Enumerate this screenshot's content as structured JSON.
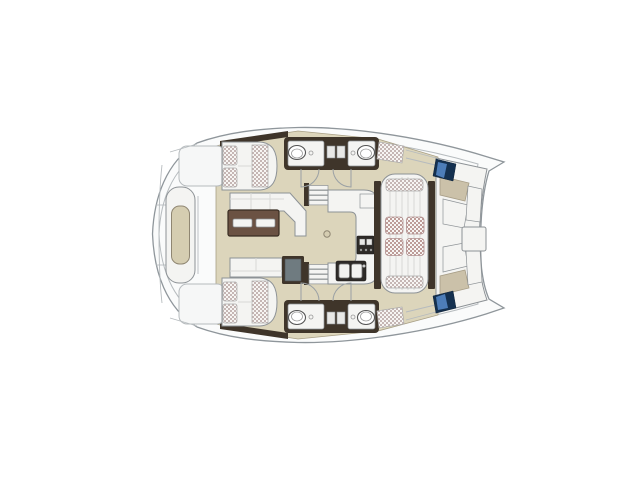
{
  "page": {
    "background": "#ffffff",
    "content": "top-view catamaran yacht floor plan, no text labels"
  },
  "colors": {
    "background": "#ffffff",
    "hull_fill": "#fafbfb",
    "hull_stroke": "#8f969b",
    "deck_line": "#b6bbbe",
    "floor_beige": "#dcd5bb",
    "floor_beige_edge": "#a89f85",
    "wall_brown": "#3f352a",
    "furniture_white": "#f4f4f2",
    "furniture_stroke": "#8d9296",
    "table_wood": "#6b5243",
    "table_wood_dark": "#382c22",
    "appliance_dark": "#2e2b28",
    "tan_seat": "#cbc1a9",
    "tan_seat_stroke": "#a79d86",
    "window_navy": "#14304f",
    "window_blue": "#4d7db8",
    "cushion_dot": "#c5b6b4",
    "cushion_dot_red": "#bd9c98",
    "cushion_bg": "#f7f5f3"
  },
  "vessel": {
    "kind": "catamaran-deck-plan",
    "areas": [
      "foredeck-lounge-pad",
      "cabin-upper-with-double-berth",
      "cabin-lower-with-double-berth",
      "bathrooms-upper-pair-with-sinks",
      "bathrooms-lower-pair-with-sinks",
      "salon-l-sofa-and-wood-table",
      "tv-cabinet",
      "galley-u-counter-with-stove-and-double-sink",
      "companionway-stairs-upper",
      "companionway-stairs-lower",
      "center-sunbed-lounge-four-cushions",
      "cockpit-seating-and-table",
      "hull-windows-navy",
      "side-deck-tread-pads"
    ]
  }
}
